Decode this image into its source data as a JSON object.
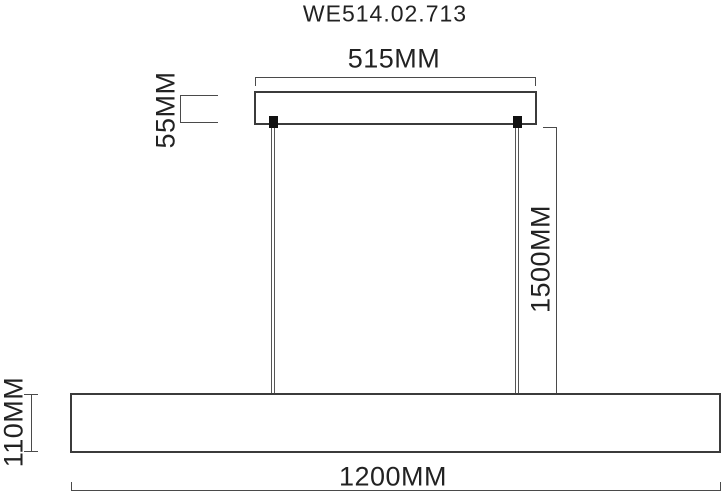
{
  "title": "WE514.02.713",
  "dimensions": {
    "canopy_width": "515MM",
    "canopy_height": "55MM",
    "suspension_length": "1500MM",
    "body_height": "110MM",
    "body_width": "1200MM"
  },
  "colors": {
    "background": "#ffffff",
    "object_line": "#3b3b3b",
    "dimension_line": "#4a4a4a",
    "text": "#222222"
  }
}
